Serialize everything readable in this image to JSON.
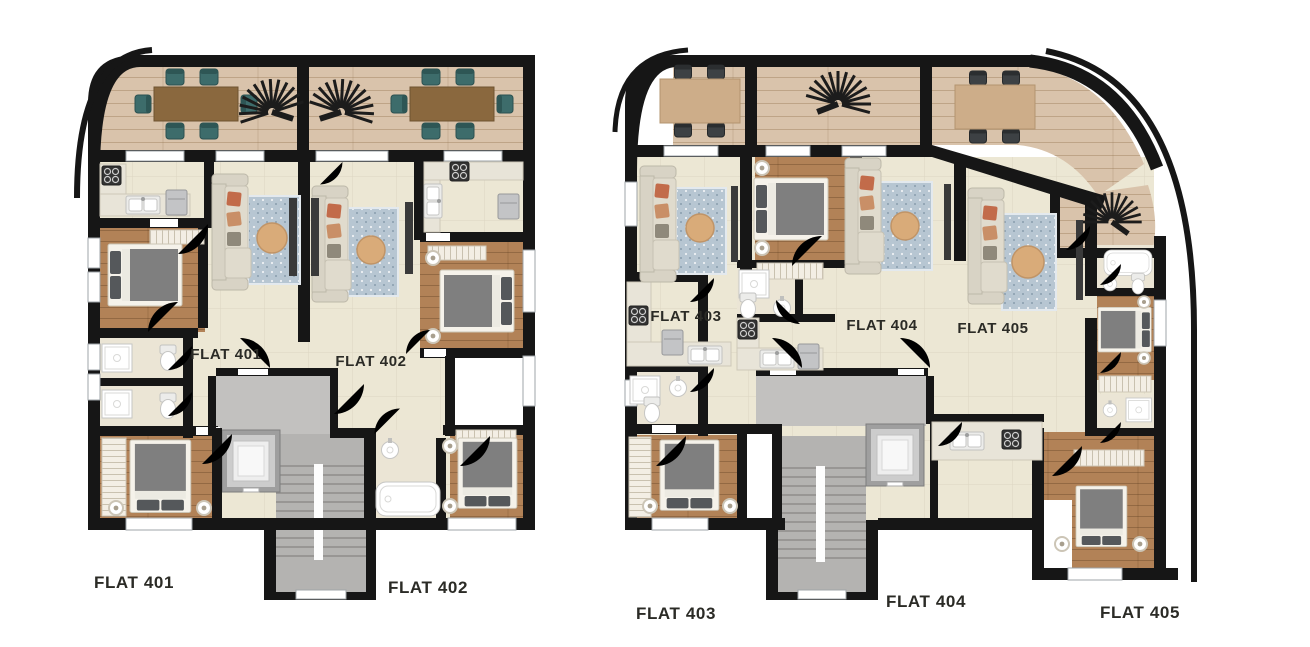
{
  "page": {
    "background": "#ffffff",
    "type": "architectural floor plan, two blocks, five flats"
  },
  "flats": [
    {
      "number": "401",
      "inner_label": "FLAT 401",
      "outer_label": "FLAT 401"
    },
    {
      "number": "402",
      "inner_label": "FLAT 402",
      "outer_label": "FLAT 402"
    },
    {
      "number": "403",
      "inner_label": "FLAT 403",
      "outer_label": "FLAT 403"
    },
    {
      "number": "404",
      "inner_label": "FLAT 404",
      "outer_label": "FLAT 404"
    },
    {
      "number": "405",
      "inner_label": "FLAT 405",
      "outer_label": "FLAT 405"
    }
  ],
  "colors": {
    "wall": "#161616",
    "terraceWood": "#d9c3ab",
    "livingFloor": "#ece7d4",
    "woodFloor": "#b28257",
    "bathFloor": "#ebe5d5",
    "stairGray": "#b4b3b1",
    "landingGray": "#c2c1bf",
    "sofa": "#d8d3c5",
    "pillowAccent": "#c26b4a",
    "rug": "#b7c6d2",
    "coffee": "#d9ab79",
    "chairTeal": "#3d6c6b",
    "chairDark": "#3d4144",
    "tableDark": "#8a683e",
    "tableLight": "#cdad89",
    "mattress": "#7f7f7f",
    "bedFrame": "#f5f2ea",
    "pillowDark": "#55585b",
    "labelColor": "#2b2b26",
    "whiteRoom": "#ffffff"
  },
  "icons": [
    "dining-table",
    "dining-chair",
    "fan-plant",
    "sofa",
    "area-rug",
    "coffee-table",
    "tv-unit",
    "double-bed",
    "nightstand",
    "wardrobe",
    "toilet",
    "washbasin",
    "shower",
    "bathtub",
    "kitchen-sink",
    "stove",
    "fridge",
    "elevator",
    "staircase",
    "door-swing",
    "window"
  ]
}
